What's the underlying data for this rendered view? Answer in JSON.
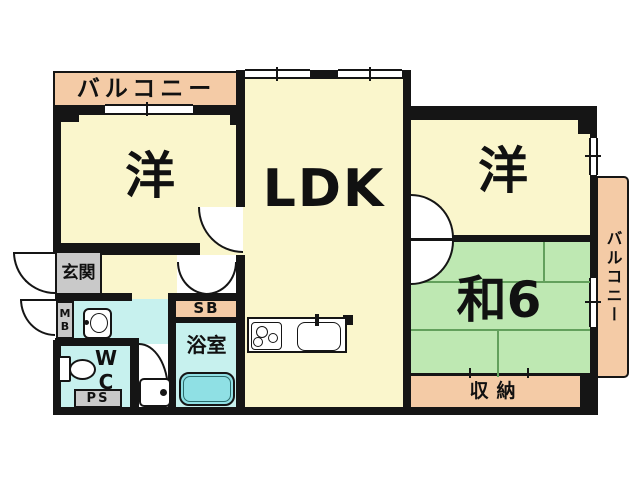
{
  "plan_type": "apartment-floorplan",
  "colors": {
    "cream": "#FAF6CC",
    "salmon": "#F4CBA6",
    "green": "#BEE8B2",
    "cyan": "#C7F1EE",
    "tub": "#8FE0E4",
    "gray": "#C9C9C9",
    "wall": "#151515",
    "tat": "#63A05C"
  },
  "rooms": {
    "balcony_top": {
      "label": "バルコニー"
    },
    "balcony_right": {
      "label": "バルコニー"
    },
    "western_left": {
      "label": "洋"
    },
    "ldk": {
      "label": "LDK"
    },
    "western_right": {
      "label": "洋"
    },
    "japanese_room": {
      "label": "和6"
    },
    "storage": {
      "label": "収納"
    },
    "entrance": {
      "label": "玄関"
    },
    "shoe_box": {
      "label": "SB"
    },
    "bathroom": {
      "label": "浴室"
    },
    "toilet": {
      "label": "WC"
    },
    "meter_box": {
      "label": "MB"
    },
    "pipe_space": {
      "label": "PS"
    }
  }
}
